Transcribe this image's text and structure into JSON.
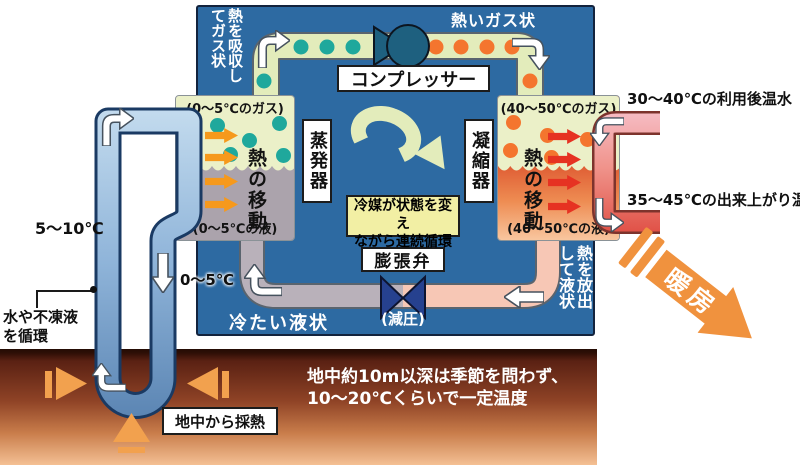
{
  "colors": {
    "blue_box": "#2d6aa2",
    "pipe_green": "#e3ecbb",
    "gas_area": "#ebf0c8",
    "liquid_gray": "#aba3ac",
    "teal_dot": "#1fa89c",
    "orange_dot": "#f4752e",
    "compressor": "#1e607f",
    "valve_blue": "#26418f",
    "heat_orange": "#f6991c",
    "heat_red": "#e63222",
    "water_light": "#c3dbee",
    "water_mid": "#8fb4d9",
    "water_dark": "#5c86b4",
    "water_outline": "#1a3a63",
    "pink_light": "#f6bcc4",
    "pink_mid": "#f0948c",
    "pink_dark": "#e05146",
    "pink_outline": "#7d332c",
    "hot_liquid_top": "#d94a28",
    "hot_liquid_mid": "#ee8c52",
    "hot_liquid_bottom": "#f9c9a3",
    "ground_arrow": "#f2a14e",
    "danbou": "#f0923e",
    "note_yellow": "#f2efa4"
  },
  "pump": {
    "absorb_label": "熱を吸収し\nてガス状",
    "hot_gas_label": "熱いガス状",
    "compressor_label": "コンプレッサー",
    "evaporator": {
      "name": "蒸発器",
      "gas_label": "(0〜5℃のガス)",
      "liquid_label": "(0〜5℃の液)",
      "heat_transfer_label": "熱の移動"
    },
    "condenser": {
      "name": "凝縮器",
      "gas_label": "(40〜50℃のガス)",
      "liquid_label": "(40〜50℃の液)",
      "heat_transfer_label": "熱の移動"
    },
    "cycle_note": "冷媒が状態を変え\nながら連続循環",
    "expansion_valve_label": "膨張弁",
    "decompression_label": "(減圧)",
    "cold_liquid_label": "冷たい液状",
    "release_label": "熱を放出\nして液状"
  },
  "ground_loop": {
    "warm_temp_label": "5〜10℃",
    "cold_temp_label": "0〜5℃",
    "circulation_label": "水や不凍液\nを循環",
    "heat_extraction_label": "地中から採熱"
  },
  "ground": {
    "note": "地中約10m以深は季節を問わず、\n10〜20℃くらいで一定温度"
  },
  "hot_water": {
    "return_label": "30〜40℃の利用後温水",
    "supply_label": "35〜45℃の出来上がり温水",
    "heating_label": "暖房"
  }
}
